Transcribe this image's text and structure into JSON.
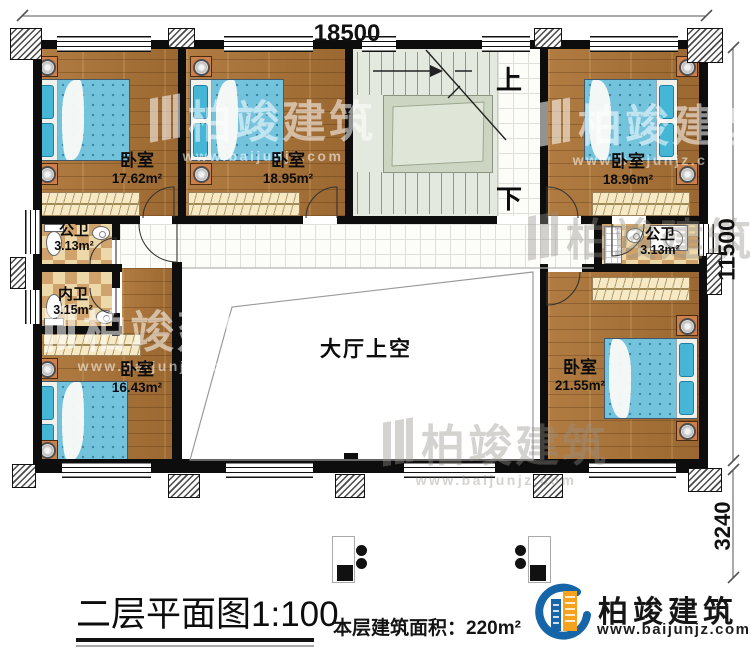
{
  "plan": {
    "title": "二层平面图",
    "scale": "1:100",
    "area_label": "本层建筑面积：",
    "area_value": "220m²",
    "dimensions": {
      "top": "18500",
      "right_upper": "11500",
      "right_lower": "3240"
    },
    "stairs": {
      "up": "上",
      "down": "下"
    }
  },
  "rooms": [
    {
      "name": "卧室",
      "area": "17.62m²"
    },
    {
      "name": "卧室",
      "area": "18.95m²"
    },
    {
      "name": "卧室",
      "area": "18.96m²"
    },
    {
      "name": "公卫",
      "area": "3.13m²"
    },
    {
      "name": "内卫",
      "area": "3.15m²"
    },
    {
      "name": "卧室",
      "area": "16.43m²"
    },
    {
      "name": "公卫",
      "area": "3.13m²"
    },
    {
      "name": "卧室",
      "area": "21.55m²"
    },
    {
      "name": "大厅上空",
      "area": ""
    }
  ],
  "branding": {
    "logo_name": "柏竣建筑",
    "logo_url": "www.baijunjz.com"
  },
  "watermark": {
    "name": "柏竣建筑",
    "url": "www.baijunjz.com"
  },
  "colors": {
    "logo_blue": "#1665a8",
    "logo_orange": "#f7a21e",
    "wood": "#a9743c",
    "mattress": "#74c3dd",
    "stair": "#e4e9df"
  }
}
